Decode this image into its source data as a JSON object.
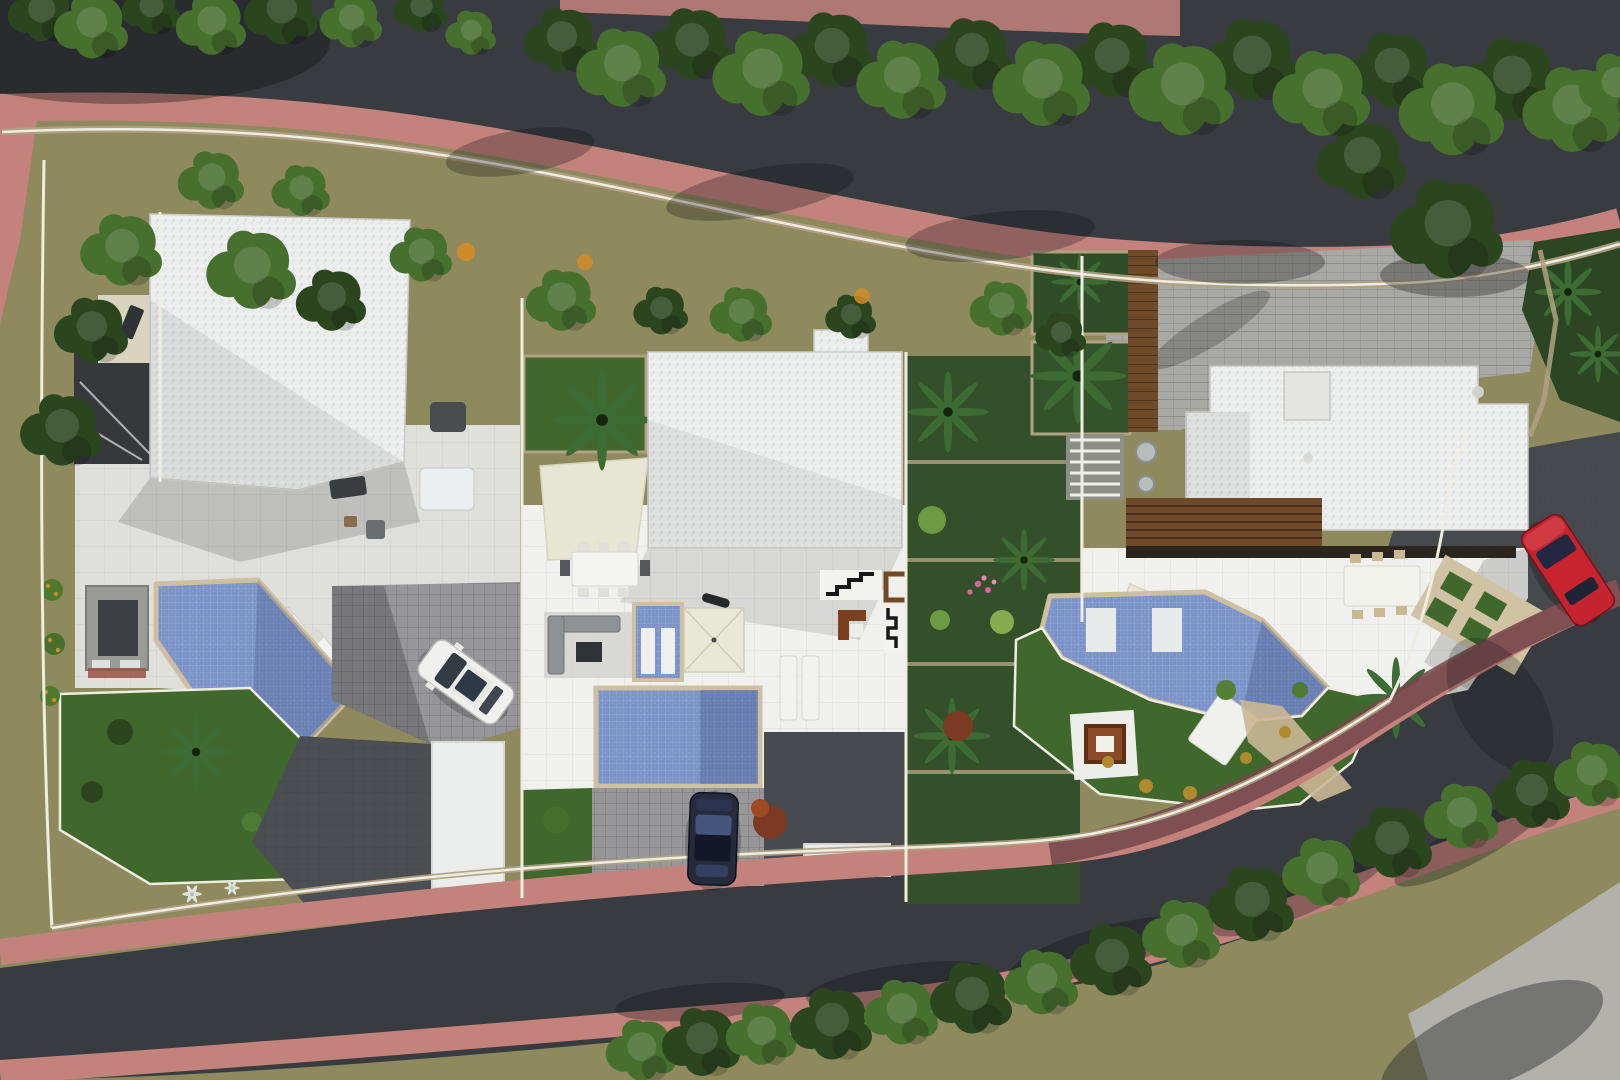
{
  "meta": {
    "title": "aerial-site-plan-render",
    "width_px": 1620,
    "height_px": 1080,
    "view": "top-down 3D architectural visualization",
    "villa_count": 3,
    "pool_count": 3,
    "car_count": 3
  },
  "colors": {
    "asphalt": "#383c40",
    "asphalt_light": "#46494d",
    "sidewalk_pink": "#c4827c",
    "sidewalk_maroon": "#74464a",
    "concrete_light": "#b3b1ac",
    "ground_olive": "#8e8a5e",
    "lawn": "#41682c",
    "lawn_dark": "#2c4522",
    "tree_dark": "#2b461f",
    "tree_mid": "#47702f",
    "tree_light": "#6d9a47",
    "palm": "#3c6b33",
    "roof_white": "#ebecec",
    "terrace": "#dfe0dc",
    "terrace_bright": "#f0f1ee",
    "paver_gray": "#97979a",
    "paver_stone": "#a8a8a4",
    "paver_dark": "#4b4f53",
    "pool": "#7b93c8",
    "pool_deep": "#44598c",
    "coping": "#cdbfa0",
    "wall_white": "#efece2",
    "wall_tan": "#b0a183",
    "wood": "#6e4a28",
    "wood_dark": "#2b2520",
    "beige": "#d8d4bd",
    "cream": "#e9e8d6",
    "kitchen_gray": "#9a9a96",
    "furniture_dark": "#3a3d40",
    "car_white": "#f0f0ee",
    "car_dark": "#262b3b",
    "car_red": "#c42430",
    "accent_orange": "#cf8a2a",
    "flower_pink": "#d864a0",
    "shrub_red": "#7c3a24",
    "shadow": "#0b0e12"
  },
  "scene": {
    "roads": [
      "top-curving-road",
      "bottom-curving-road"
    ],
    "sidewalks": [
      "pink-top-sidewalk",
      "pink-bottom-sidewalk",
      "shaded-maroon-sidewalk"
    ],
    "plots": [
      {
        "name": "villa-left",
        "features": [
          "white-gravel-roof",
          "terrace",
          "angled-pool",
          "outdoor-kitchen",
          "three-loungers",
          "lawn-garden",
          "driveway",
          "garage",
          "white-car"
        ]
      },
      {
        "name": "villa-middle",
        "features": [
          "white-gravel-roof",
          "shade-sail",
          "dining-set",
          "lounge-set",
          "spa",
          "parasol",
          "pool",
          "bbq-terrace",
          "two-loungers",
          "driveway",
          "dark-car"
        ]
      },
      {
        "name": "villa-right",
        "features": [
          "white-gravel-roof",
          "stone-parking",
          "wood-pergola",
          "terrace",
          "dining-set",
          "angled-pool-with-sunbeds",
          "lawn",
          "fire-pit",
          "lounger",
          "driveway",
          "red-car"
        ]
      }
    ],
    "vegetation": [
      "street-tree-rows",
      "garden-trees",
      "palms",
      "agaves",
      "orange-fruit-trees",
      "flower-bushes",
      "bottom-hedge-row"
    ]
  }
}
